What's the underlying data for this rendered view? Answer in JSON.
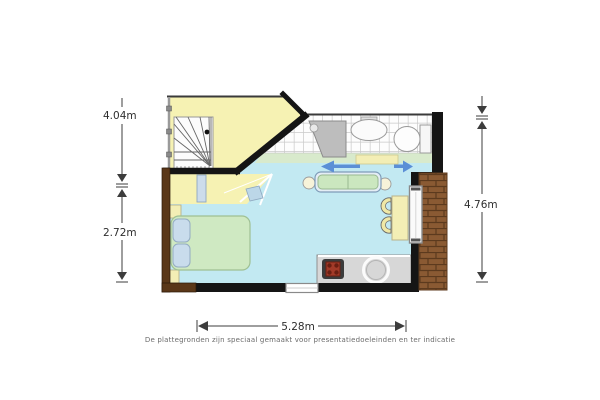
{
  "image": {
    "type": "apartment-floor-plan",
    "background": "#ffffff"
  },
  "dimensions": {
    "left_upper": "4.04m",
    "left_lower": "2.72m",
    "right": "4.76m",
    "bottom": "5.28m"
  },
  "disclaimer": "De plattegronden zijn speciaal gemaakt voor presentatiedoeleinden en ter indicatie",
  "rooms": [
    {
      "name": "landing-with-spiral-staircase",
      "floor_color": "#f6f2b3"
    },
    {
      "name": "bathroom",
      "floor_color": "#fdfdfd"
    },
    {
      "name": "living-bedroom-kitchen",
      "floor_color": "#c2e9f2"
    },
    {
      "name": "balcony-terrace",
      "floor_color": "#8a5a33"
    }
  ],
  "furniture": [
    "spiral-staircase",
    "radiator",
    "bed",
    "pillow",
    "pillow",
    "nightstand",
    "nightstand",
    "sofa",
    "side-table",
    "side-table",
    "dining-table",
    "chair",
    "chair",
    "kitchen-counter",
    "stove",
    "kitchen-sink",
    "shower",
    "washbasin",
    "toilet",
    "sliding-door-arrows",
    "glass-door",
    "window"
  ],
  "colors": {
    "wall": "#151515",
    "wall_exterior_brown": "#5a3718",
    "brick": "#8a5a33",
    "floor_main": "#c2e9f2",
    "floor_landing": "#f6f2b3",
    "bed_green": "#cfe9c2",
    "sofa_seat_green": "#cbe7bf",
    "pillow_blue": "#c9dcec",
    "arrow_blue": "#5b8fd6",
    "kitchen_gray": "#d7d7d7",
    "stove_red": "#a23a28",
    "dimension_text": "#2e2e2e"
  }
}
